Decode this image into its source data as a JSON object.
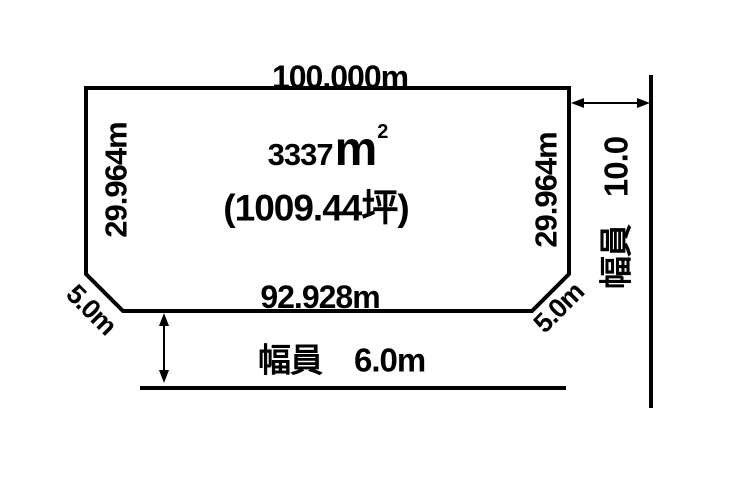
{
  "diagram": {
    "parcel": {
      "top_edge_length": "100.000m",
      "left_edge_length": "29.964m",
      "right_edge_length": "29.964m",
      "bottom_edge_length": "92.928m",
      "left_corner_cut_length": "5.0m",
      "right_corner_cut_length": "5.0m",
      "area_sqm_value": "3337",
      "area_sqm_unit": "m",
      "area_sqm_exponent": "2",
      "area_tsubo": "(1009.44坪)"
    },
    "right_road": {
      "width_value": "10.0",
      "width_label": "幅員"
    },
    "bottom_road": {
      "width_label": "幅員",
      "width_value": "6.0m"
    },
    "colors": {
      "line": "#000000",
      "text": "#000000",
      "background": "#ffffff"
    }
  }
}
